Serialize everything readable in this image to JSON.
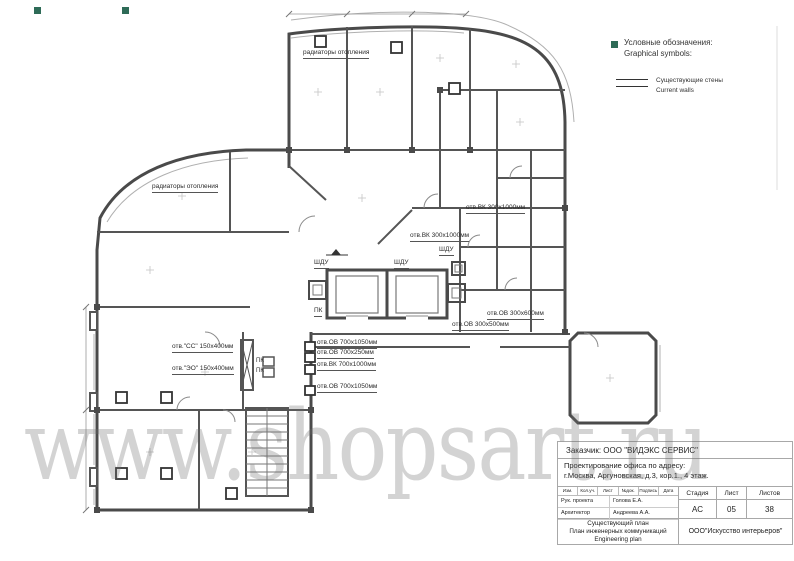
{
  "sheet": {
    "bg": "#ffffff"
  },
  "watermark": {
    "text": "www.shopsart.ru",
    "color": "#6f6f6f"
  },
  "legend": {
    "title_ru": "Условные обозначения:",
    "title_en": "Graphical symbols:",
    "wall_symbol": "double-line",
    "wall_label_ru": "Существующие стены",
    "wall_label_en": "Current walls"
  },
  "plan": {
    "colors": {
      "wall": "#4a4a4a",
      "thin": "#9a9a9a",
      "grip": "#2e6b57"
    },
    "labels": [
      {
        "text": "радиаторы отопления"
      },
      {
        "text": "радиаторы отопления"
      },
      {
        "text": "отв.ВК 300х1000мм"
      },
      {
        "text": "отв.ВК 300х1000мм"
      },
      {
        "text": "ШДУ"
      },
      {
        "text": "ШДУ"
      },
      {
        "text": "ШДУ"
      },
      {
        "text": "ПК"
      },
      {
        "text": "отв.ОВ 300х600мм"
      },
      {
        "text": "отв.ОВ 300х500мм"
      },
      {
        "text": "отв.ОВ 700х1050мм"
      },
      {
        "text": "отв.ОВ 700х250мм"
      },
      {
        "text": "отв.ВК 700х1000мм"
      },
      {
        "text": "отв.ОВ 700х1050мм"
      },
      {
        "text": "отв.\"СС\" 150х400мм"
      },
      {
        "text": "отв.\"ЭО\" 150х400мм"
      },
      {
        "text": "ПК"
      },
      {
        "text": "ПК"
      }
    ]
  },
  "title_block": {
    "client": "Заказчик: ООО \"ВИДЭКС СЕРВИС\"",
    "project_line1": "Проектирование офиса по адресу:",
    "project_line2": "г.Москва, Аргуновская, д.3, кор.1., 4 этаж.",
    "rev_header": [
      "Изм.",
      "Кол.уч.",
      "Лист",
      "№док.",
      "Подпись",
      "Дата"
    ],
    "roles": [
      {
        "role": "Рук. проекта",
        "name": "Голова Е.А."
      },
      {
        "role": "Архитектор",
        "name": "Андреева А.А."
      }
    ],
    "stage_header": [
      "Стадия",
      "Лист",
      "Листов"
    ],
    "stage_values": [
      "АС",
      "05",
      "38"
    ],
    "doc_title_lines": [
      "Существующий план",
      "План инженерных коммуникаций",
      "Engineering plan"
    ],
    "company": "ООО\"Искусство интерьеров\""
  }
}
